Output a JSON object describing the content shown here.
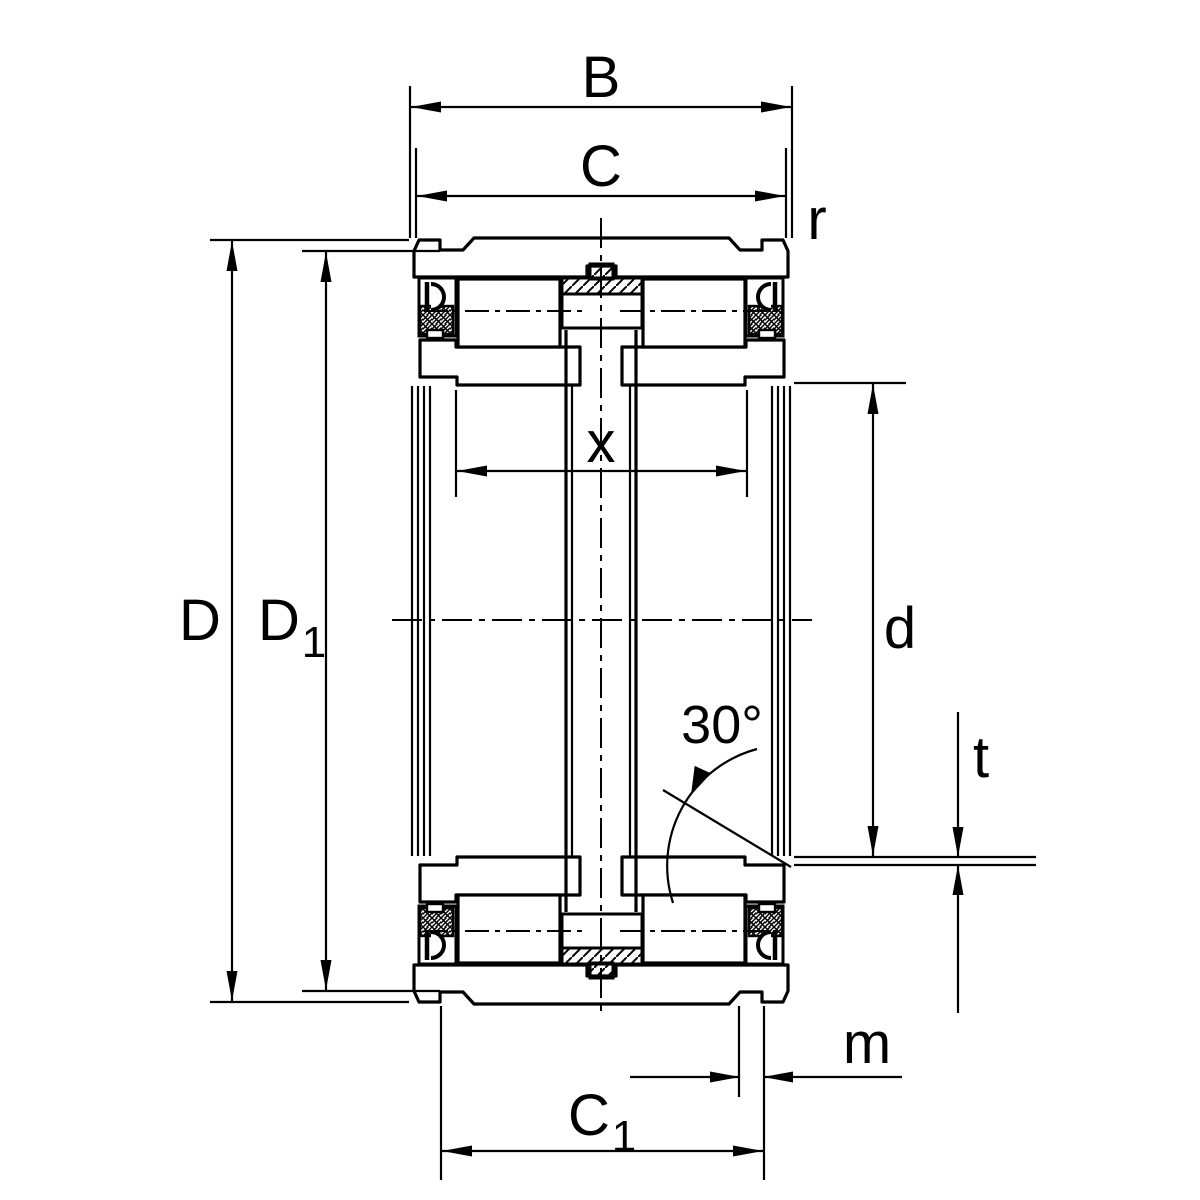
{
  "drawing": {
    "type": "bearing-cross-section-technical-drawing",
    "description": "Sectional drawing of a double-row full-complement cylindrical roller bearing with seals, with dimension annotations",
    "colors": {
      "line": "#000000",
      "background": "#ffffff"
    },
    "labels": {
      "B": "B",
      "C": "C",
      "r": "r",
      "x": "x",
      "D": "D",
      "D1_base": "D",
      "D1_sub": "1",
      "d": "d",
      "angle": "30°",
      "t": "t",
      "m": "m",
      "C1_base": "C",
      "C1_sub": "1"
    }
  }
}
